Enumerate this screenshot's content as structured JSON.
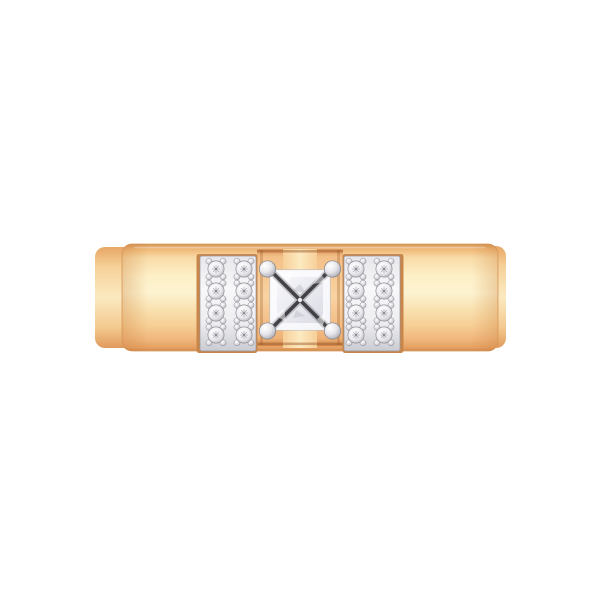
{
  "scene": {
    "description": "Rose gold band ring, front view, with princess-cut center diamond in four round prongs and two white-gold pave panels of round diamonds",
    "center_stone": {
      "shape": "princess-cut",
      "prong_count": 4
    },
    "pave_summary": {
      "panels": 2,
      "columns_per_panel": 2,
      "rows_per_panel": 4,
      "stones_per_panel": 8,
      "total_side_stones": 16
    }
  },
  "colors": {
    "background": "#ffffff",
    "band_outline": "#d99a5d",
    "top_highlight": "#ffffff",
    "side_shade": "#c97a35",
    "band_gradient": [
      "#d39455",
      "#efb877",
      "#f8dca8",
      "#fdf0c8",
      "#fdf3d0",
      "#f9e0ae",
      "#f6cf96",
      "#f0b67c",
      "#e5a062",
      "#d18a4e"
    ],
    "back_band_gradient": [
      "#e8a765",
      "#f6d199",
      "#fbe9c0",
      "#f3c98e",
      "#e19a5c"
    ],
    "center_recess_gradient": [
      "#d8955b",
      "#f4c089",
      "#f8d3a2",
      "#efb277",
      "#cf8950"
    ],
    "pillar_gradient": [
      "#f7cf98",
      "#fdeac1",
      "#f7cf98"
    ],
    "notch_shadow": "#96521f",
    "panel": {
      "edge": "#c8864a",
      "outline": "#96979e",
      "gradient": [
        "#e7e7eb",
        "#f8f8fa",
        "#eeeef1",
        "#cbccd2"
      ]
    },
    "stone": {
      "outline": "#8f9097",
      "facet": "#a0a1a9",
      "center_dot": "#75767e",
      "gradient": [
        "#ffffff",
        "#eeeef2",
        "#b5b6bd"
      ]
    },
    "bead_gradient": [
      "#ffffff",
      "#dcdce2",
      "#97989f"
    ],
    "prong": {
      "outline": "#82838a",
      "gradient": [
        "#ffffff",
        "#e9e9ed",
        "#b9bac1",
        "#8f9096"
      ]
    },
    "diamond": {
      "outline": "#b9bac2",
      "cross": "#2b2b2f",
      "frame": "#fcfcff",
      "sparkle_white": "#ffffff",
      "sparkle_gray": "#9fa1ab",
      "gradient": [
        "#fbfbfe",
        "#e6e7ee",
        "#d6d7df"
      ]
    }
  },
  "pave": {
    "rows": 4,
    "cols": 2,
    "stone_radius": 8.1,
    "bead_radius": 3.1,
    "bead_offset_x": 7,
    "bead_offset_y": 7.8,
    "row_centers_y": [
      269,
      291,
      313,
      335
    ],
    "panels": [
      {
        "id": "left",
        "col_centers_x": [
          216,
          244
        ]
      },
      {
        "id": "right",
        "col_centers_x": [
          356,
          384
        ]
      }
    ]
  }
}
